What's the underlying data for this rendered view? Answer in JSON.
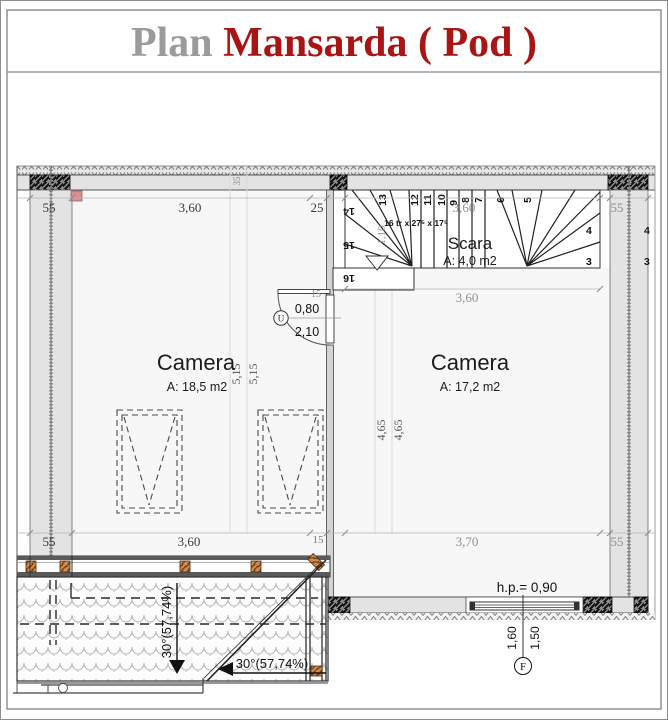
{
  "title": {
    "prefix": "Plan ",
    "main": "Mansarda ( Pod )"
  },
  "colors": {
    "title_gray": "#9b9b9b",
    "title_red": "#a91414",
    "wall_fill": "#e3e3e3",
    "partition_fill": "#d4d4d4",
    "marker_pink": "#d68f91",
    "rafter_brown": "#cf8c4e"
  },
  "dims": {
    "top": {
      "left_wall": "55",
      "left_room": "3,60",
      "segment": "25",
      "stair": "3,60",
      "right_wall": "55",
      "offset": "35"
    },
    "bottom": {
      "left_wall": "55",
      "left_room": "3,60",
      "segment": "15",
      "right_room": "3,70",
      "right_wall": "55"
    },
    "left_room_height": [
      "5,15",
      "5,15"
    ],
    "right_room_height": [
      "4,65",
      "4,65"
    ],
    "stair_width": "1,10"
  },
  "rooms": {
    "left": {
      "name": "Camera",
      "area": "A: 18,5 m2"
    },
    "right": {
      "name": "Camera",
      "area": "A: 17,2 m2"
    }
  },
  "stairs": {
    "name": "Scara",
    "area": "A: 4,0 m2",
    "spec": "16 tr x 27⁵ x 17⁵",
    "steps_top": [
      "13",
      "12",
      "11",
      "10",
      "9",
      "8",
      "7",
      "6",
      "5"
    ],
    "steps_left": [
      "14",
      "15",
      "16"
    ],
    "steps_right": [
      "4",
      "3"
    ],
    "outside_right": [
      "4",
      "3"
    ]
  },
  "door": {
    "width": "0,80",
    "height": "2,10",
    "tag": "U",
    "dim_a": "15",
    "dim_b": "10"
  },
  "window": {
    "parapet": "h.p.= 0,90",
    "dim_a": "1,60",
    "dim_b": "1,50",
    "axis": "F"
  },
  "roof": {
    "slope_vertical": "30°(57,74%)",
    "slope_horizontal": "30°(57,74%)"
  }
}
